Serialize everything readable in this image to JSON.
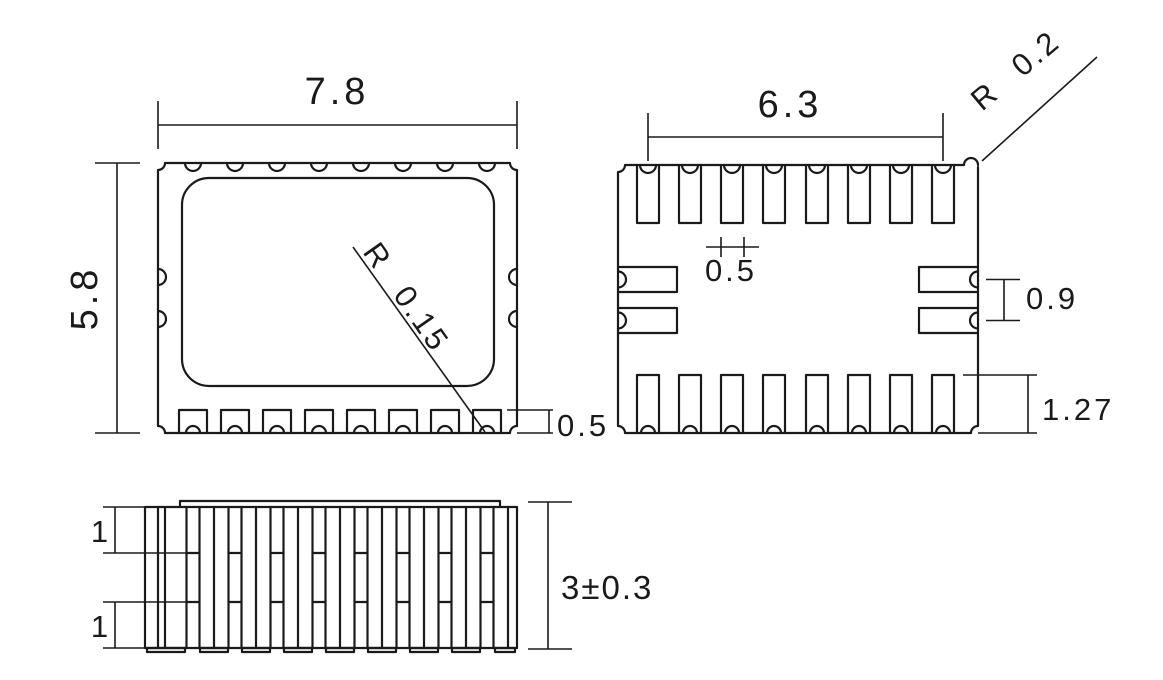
{
  "colors": {
    "line": "#1a1a1a",
    "background": "#ffffff"
  },
  "top_view": {
    "width": "7.8",
    "height": "5.8",
    "pad_notch_radius": "R 0.15",
    "pad_height": "0.5"
  },
  "bottom_view": {
    "pad_row_width": "6.3",
    "corner_radius": "R 0.2",
    "pad_width": "0.5",
    "side_pad_pitch": "0.9",
    "pad_length": "1.27"
  },
  "side_view": {
    "top_castellation_height": "1",
    "bottom_castellation_height": "1",
    "overall_height": "3±0.3"
  }
}
